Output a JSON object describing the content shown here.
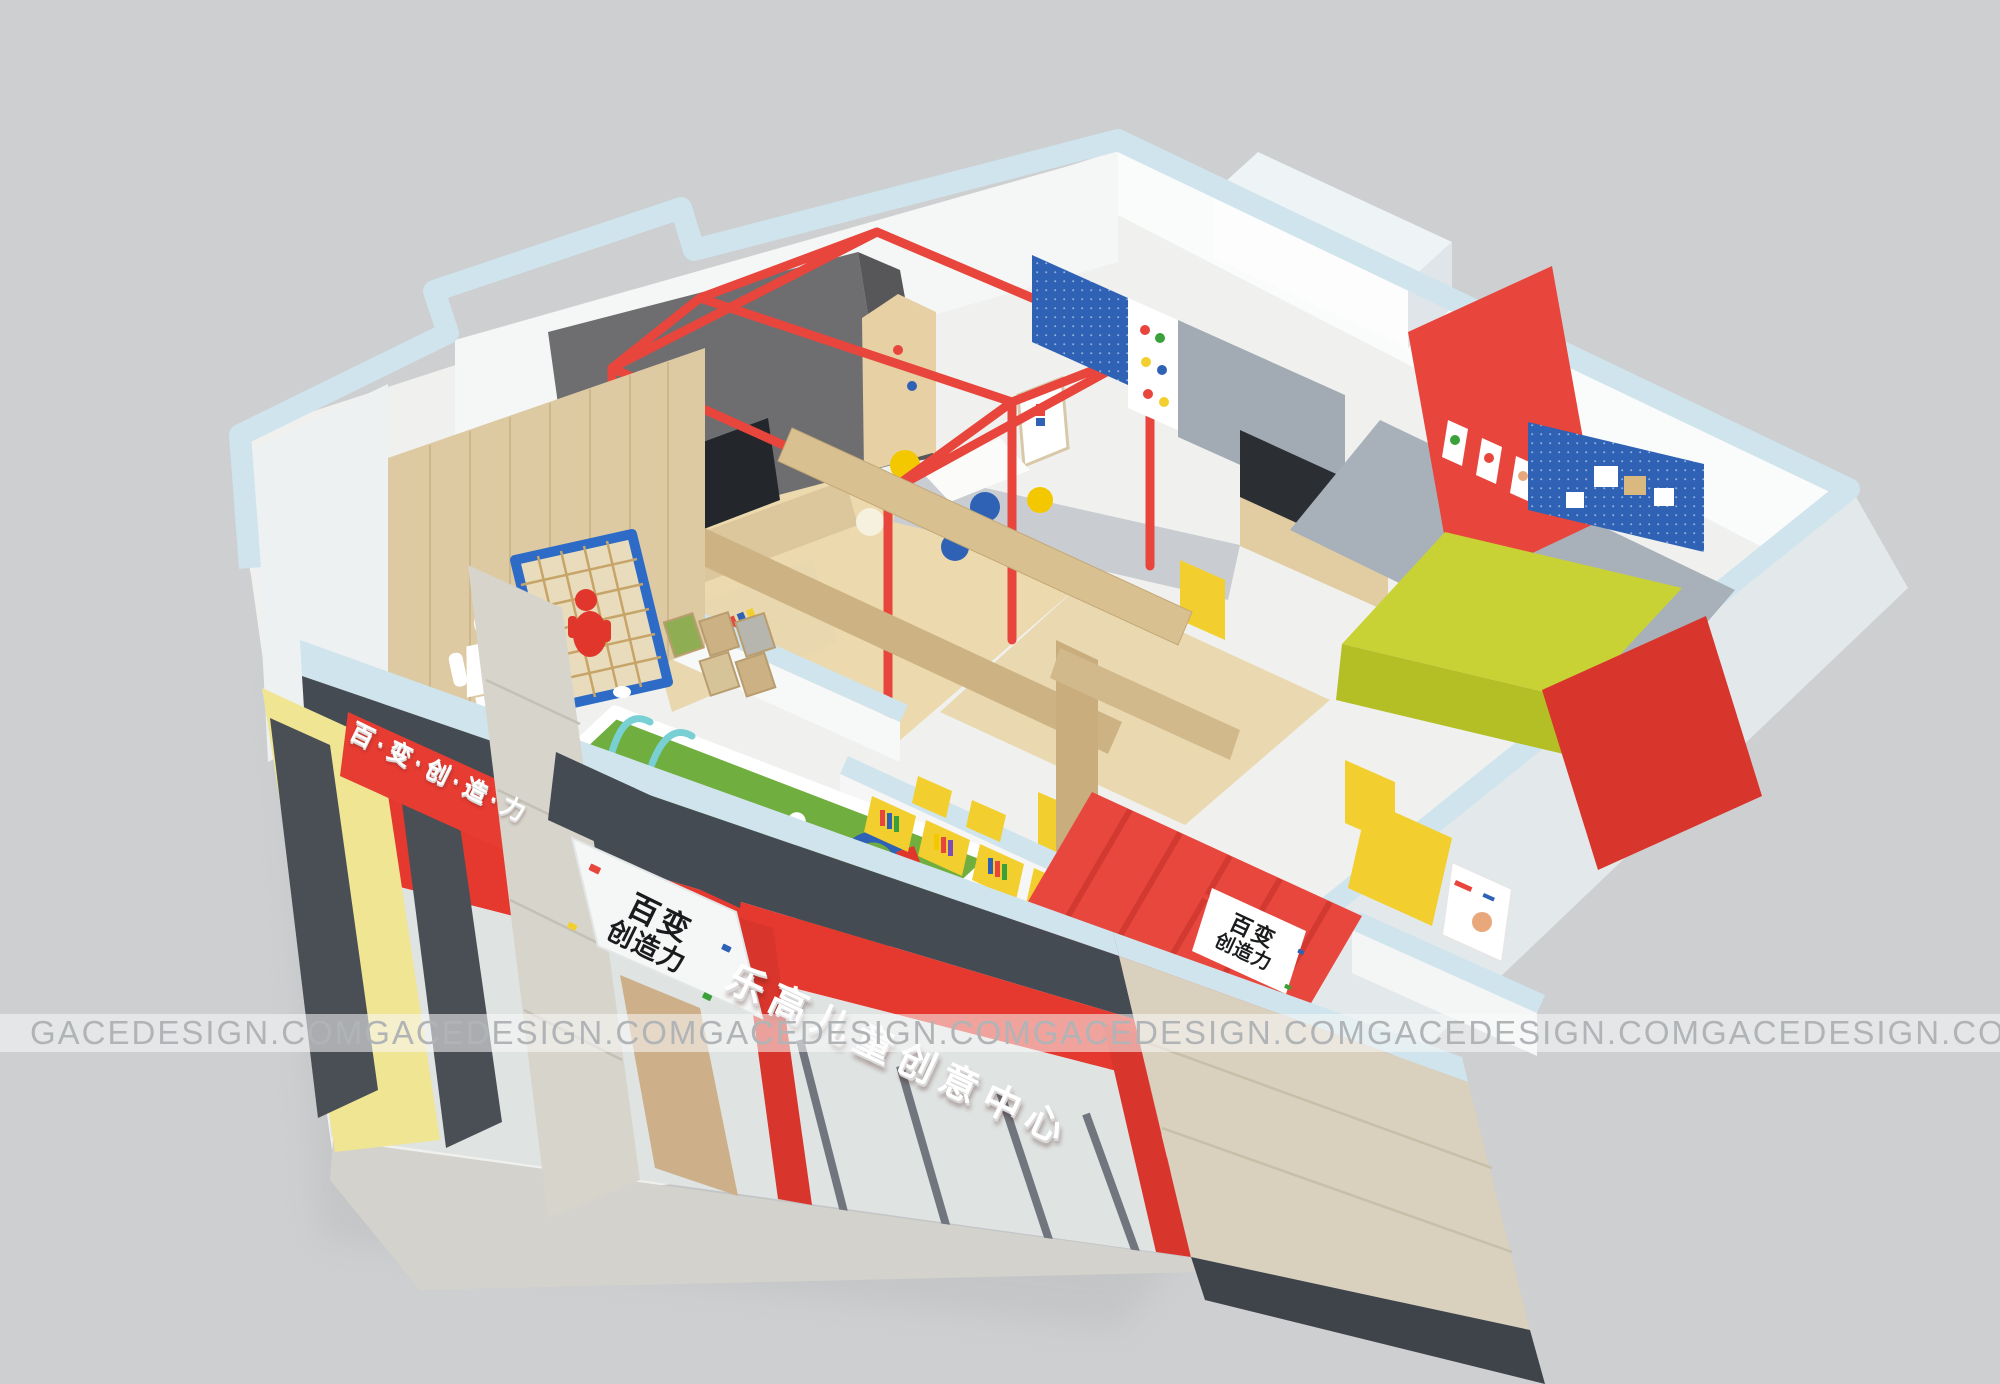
{
  "watermark": {
    "text": "GACEDESIGN.COM"
  },
  "storefront": {
    "main_sign": "乐高儿童创意中心",
    "left_banner": "百·变·创·造·力",
    "logo_line1": "百变",
    "logo_line2": "创造力"
  },
  "reception": {
    "logo_line1": "百变",
    "logo_line2": "创造力"
  },
  "colors": {
    "background": "#cdcfd1",
    "slab_blue": "#cfe4ec",
    "canopy_dark": "#454b53",
    "sign_red": "#e5382e",
    "lego_red": "#e8453c",
    "banner_red": "#e63c32",
    "storefront_yellow": "#efe593",
    "accent_yellow": "#f2cf2e",
    "pegboard_blue": "#2f62b5",
    "net_frame_blue": "#2e6bc6",
    "grass_green": "#6fae3f",
    "lime_table": "#c9d234",
    "wood_wall": "#ddcaa3",
    "wood_floor": "#ecd9ae",
    "cabinet_gray": "#6e6e71",
    "concrete": "#d7d4cb",
    "beige_stone": "#d9d0bd",
    "terrazzo": "#e9eae6",
    "reception_floor_red": "#e8473e",
    "watermark_text": "#b1b4b6"
  }
}
